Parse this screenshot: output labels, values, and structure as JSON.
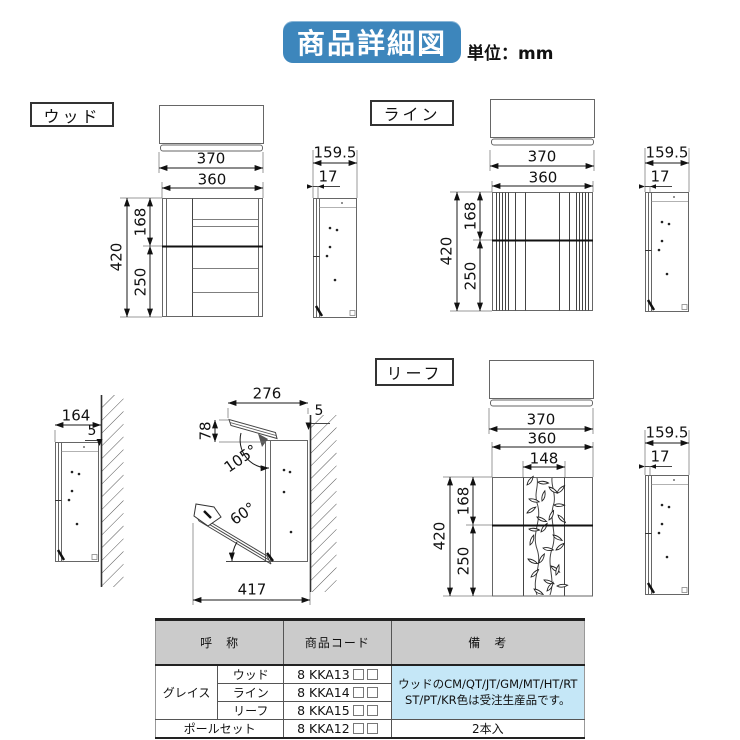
{
  "title": "商品詳細図",
  "unit": "単位：mm",
  "colors": {
    "title_bg": "#3d86bc",
    "table_header_bg": "#cbcbcb",
    "remarks_bg": "#c5e7f7"
  },
  "sections": {
    "wood": {
      "label": "ウッド"
    },
    "line": {
      "label": "ライン"
    },
    "leaf": {
      "label": "リーフ"
    }
  },
  "dims": {
    "front_top_w": "370",
    "front_w": "360",
    "front_h": "420",
    "front_upper": "168",
    "front_lower": "250",
    "leaf_panel_w": "148",
    "side_d": "159.5",
    "side_t": "17",
    "wall_d": "164",
    "wall_gap": "5",
    "open_top_w": "276",
    "lid_drop": "78",
    "lid_angle": "105°",
    "door_angle": "60°",
    "open_total_d": "417"
  },
  "table": {
    "headers": {
      "name": "呼　称",
      "code": "商品コード",
      "note": "備　考"
    },
    "group_label": "グレイス",
    "rows": [
      {
        "name": "ウッド",
        "code": "8 KKA13",
        "boxes": "□□"
      },
      {
        "name": "ライン",
        "code": "8 KKA14",
        "boxes": "□□"
      },
      {
        "name": "リーフ",
        "code": "8 KKA15",
        "boxes": "□□"
      }
    ],
    "pole_row": {
      "name": "ポールセット",
      "code": "8 KKA12",
      "boxes": "□□",
      "note": "2本入"
    },
    "remarks_line1": "ウッドのCM/QT/JT/GM/MT/HT/RT",
    "remarks_line2": "ST/PT/KR色は受注生産品です。"
  }
}
